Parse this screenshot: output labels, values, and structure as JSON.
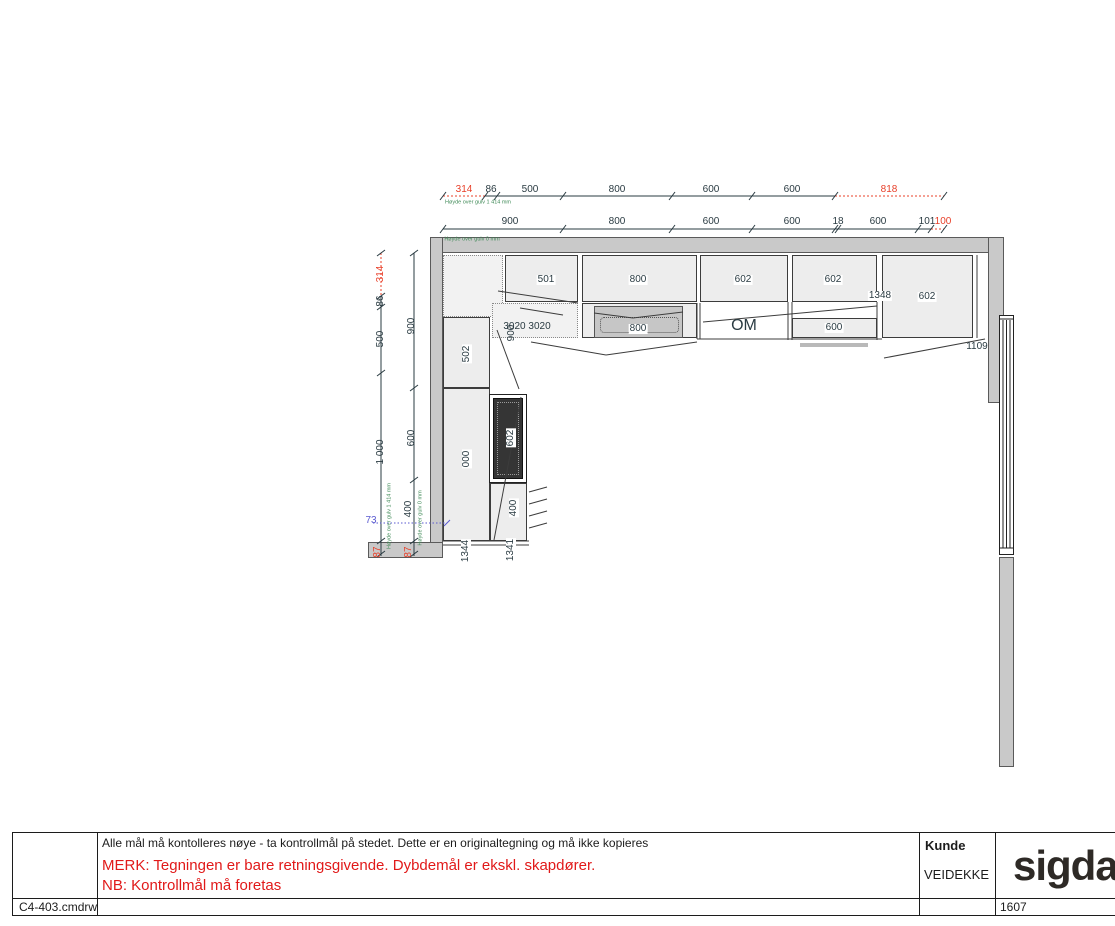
{
  "title_block": {
    "note": "Alle mål må kontolleres nøye - ta kontrollmål på stedet. Dette er en originaltegning og må ikke kopieres",
    "warning_line1": "MERK: Tegningen er bare retningsgivende. Dybdemål er ekskl. skapdører.",
    "warning_line2": "NB: Kontrollmål må foretas",
    "customer_label": "Kunde",
    "customer_name": "VEIDEKKE",
    "brand": "sigdal",
    "file_name": "C4-403.cmdrw",
    "order_number": "1607"
  },
  "colors": {
    "dimension_text": "#2a3b42",
    "warning_red": "#e8402a",
    "height_note_green": "#3f8a57",
    "reference_blue": "#5a5ad0",
    "wall_gray": "#c9c9c9",
    "cabinet_fill": "#ededed",
    "appliance_dark": "#353535"
  },
  "drawing": {
    "labels": [
      {
        "t": "314",
        "x": 464,
        "y": 190,
        "c": "red"
      },
      {
        "t": "86",
        "x": 491,
        "y": 190
      },
      {
        "t": "500",
        "x": 530,
        "y": 190
      },
      {
        "t": "800",
        "x": 617,
        "y": 190
      },
      {
        "t": "600",
        "x": 711,
        "y": 190
      },
      {
        "t": "600",
        "x": 792,
        "y": 190
      },
      {
        "t": "818",
        "x": 889,
        "y": 190,
        "c": "red"
      },
      {
        "t": "Høyde over gulv 1 414 mm",
        "x": 478,
        "y": 203,
        "c": "green",
        "s": 5.5,
        "k": "n"
      },
      {
        "t": "900",
        "x": 510,
        "y": 222
      },
      {
        "t": "800",
        "x": 617,
        "y": 222
      },
      {
        "t": "600",
        "x": 711,
        "y": 222
      },
      {
        "t": "600",
        "x": 792,
        "y": 222
      },
      {
        "t": "18",
        "x": 838,
        "y": 222
      },
      {
        "t": "600",
        "x": 878,
        "y": 222
      },
      {
        "t": "101",
        "x": 927,
        "y": 222
      },
      {
        "t": "100",
        "x": 943,
        "y": 222,
        "c": "red"
      },
      {
        "t": "Høyde over gulv 0 mm",
        "x": 472,
        "y": 240,
        "c": "green",
        "s": 5.5,
        "k": "n"
      },
      {
        "t": "314",
        "x": 381,
        "y": 274,
        "r": 1,
        "c": "red"
      },
      {
        "t": "86",
        "x": 381,
        "y": 301,
        "r": 1
      },
      {
        "t": "500",
        "x": 381,
        "y": 339,
        "r": 1
      },
      {
        "t": "1 000",
        "x": 381,
        "y": 452,
        "r": 1
      },
      {
        "t": "87",
        "x": 378,
        "y": 552,
        "r": 1,
        "c": "red"
      },
      {
        "t": "900",
        "x": 412,
        "y": 326,
        "r": 1
      },
      {
        "t": "600",
        "x": 412,
        "y": 438,
        "r": 1
      },
      {
        "t": "400",
        "x": 409,
        "y": 509,
        "r": 1
      },
      {
        "t": "87",
        "x": 409,
        "y": 552,
        "r": 1,
        "c": "red"
      },
      {
        "t": "Høyde over gulv 1 414 mm",
        "x": 390,
        "y": 516,
        "r": 1,
        "c": "green",
        "s": 5.5,
        "k": "n"
      },
      {
        "t": "Høyde over gulv 0 mm",
        "x": 421,
        "y": 518,
        "r": 1,
        "c": "green",
        "s": 5.5,
        "k": "n"
      },
      {
        "t": "73",
        "x": 371,
        "y": 521,
        "c": "blue"
      },
      {
        "t": "501",
        "x": 546,
        "y": 280,
        "b": 1,
        "k": "c"
      },
      {
        "t": "800",
        "x": 638,
        "y": 280,
        "b": 1,
        "k": "c"
      },
      {
        "t": "602",
        "x": 743,
        "y": 280,
        "b": 1,
        "k": "c"
      },
      {
        "t": "602",
        "x": 833,
        "y": 280,
        "b": 1,
        "k": "c"
      },
      {
        "t": "1348",
        "x": 880,
        "y": 296,
        "b": 1
      },
      {
        "t": "602",
        "x": 927,
        "y": 297,
        "b": 1,
        "k": "c"
      },
      {
        "t": "3020 3020",
        "x": 527,
        "y": 327,
        "k": "c"
      },
      {
        "t": "900",
        "x": 512,
        "y": 333,
        "r": 1
      },
      {
        "t": "800",
        "x": 638,
        "y": 329,
        "b": 1,
        "k": "c"
      },
      {
        "t": "OM",
        "x": 744,
        "y": 326,
        "s": 16,
        "k": "c"
      },
      {
        "t": "600",
        "x": 834,
        "y": 328,
        "b": 1,
        "k": "c"
      },
      {
        "t": "1109",
        "x": 977,
        "y": 347
      },
      {
        "t": "502",
        "x": 467,
        "y": 354,
        "r": 1,
        "b": 1,
        "k": "c"
      },
      {
        "t": "000",
        "x": 467,
        "y": 459,
        "r": 1,
        "b": 1,
        "k": "c"
      },
      {
        "t": "602",
        "x": 511,
        "y": 438,
        "r": 1,
        "b": 1,
        "k": "c"
      },
      {
        "t": "400",
        "x": 514,
        "y": 508,
        "r": 1,
        "b": 1
      },
      {
        "t": "1344",
        "x": 466,
        "y": 551,
        "r": 1,
        "b": 1
      },
      {
        "t": "1341",
        "x": 511,
        "y": 550,
        "r": 1,
        "b": 1
      }
    ]
  }
}
